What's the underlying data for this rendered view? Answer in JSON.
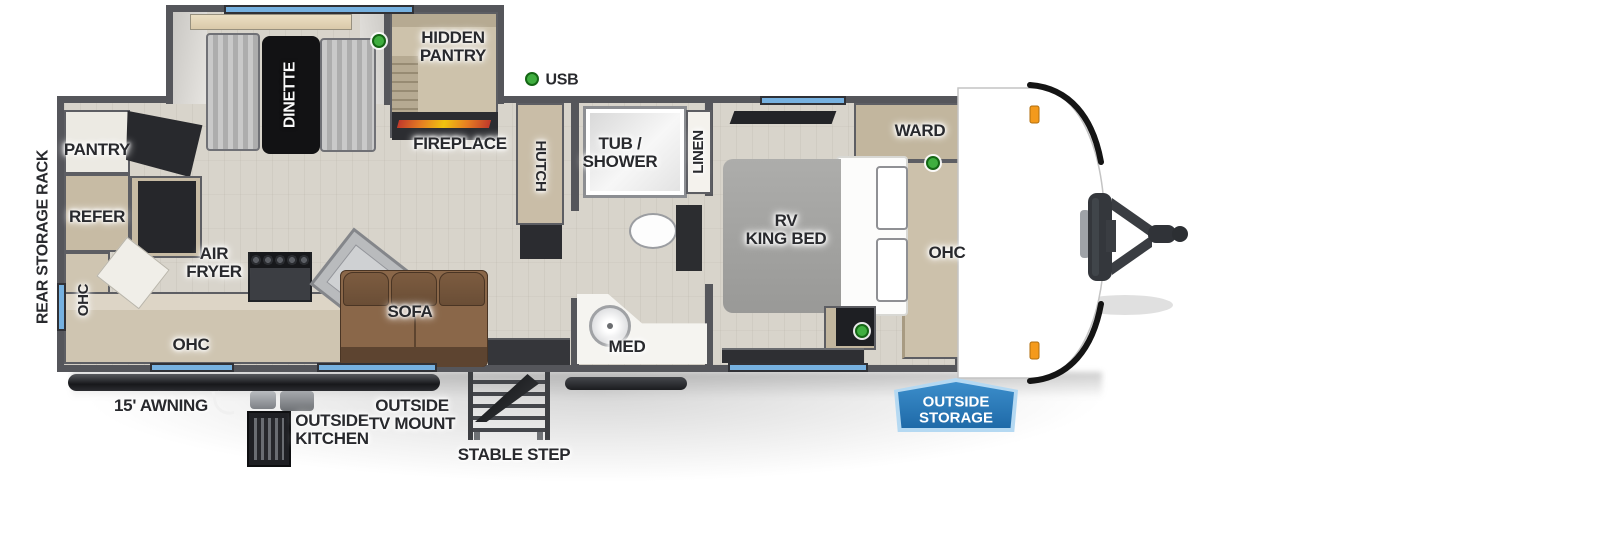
{
  "colors": {
    "wall": "#55565b",
    "floor": "#d8d4cb",
    "cabinet": "#c7bba4",
    "window_blue": "#76b1e0",
    "usb_green": "#3fae3f",
    "marker_orange": "#f49a1c",
    "badge_blue": "#2a7cc0",
    "label_text": "#28292d"
  },
  "legend": {
    "usb": "USB"
  },
  "labels": {
    "rear_storage_rack": "REAR STORAGE RACK",
    "pantry": "PANTRY",
    "refer": "REFER",
    "ohc_rear": "OHC",
    "air_fryer": "AIR\nFRYER",
    "ohc_kitchen": "OHC",
    "dinette": "DINETTE",
    "hidden_pantry": "HIDDEN\nPANTRY",
    "fireplace": "FIREPLACE",
    "hutch": "HUTCH",
    "sofa": "SOFA",
    "tub_shower": "TUB /\nSHOWER",
    "linen": "LINEN",
    "med": "MED",
    "rv_king_bed": "RV\nKING BED",
    "ward": "WARD",
    "ohc_bedroom": "OHC",
    "awning": "15' AWNING",
    "outside_kitchen": "OUTSIDE\nKITCHEN",
    "outside_tv_mount": "OUTSIDE\nTV MOUNT",
    "stable_step": "STABLE STEP",
    "outside_storage": "OUTSIDE\nSTORAGE"
  }
}
